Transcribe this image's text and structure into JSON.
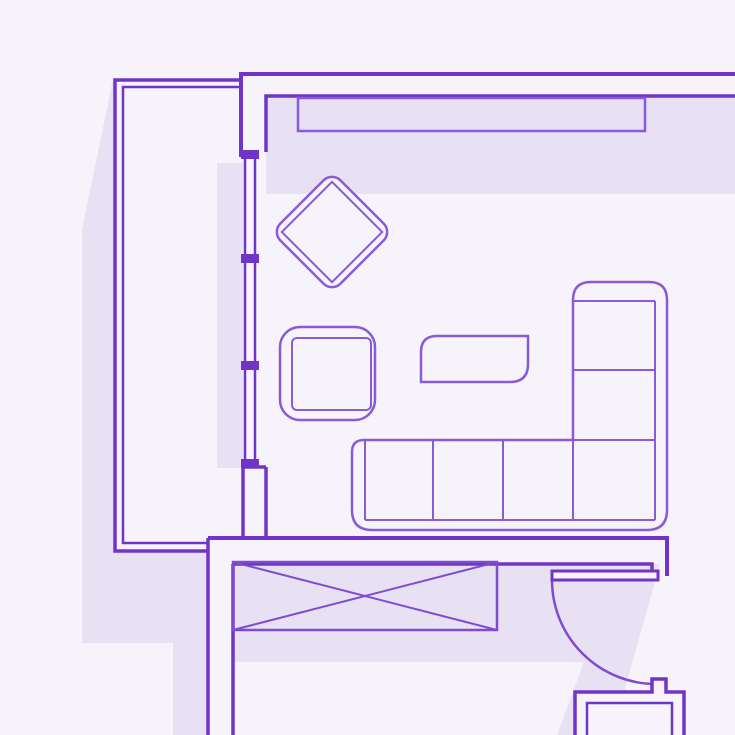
{
  "canvas": {
    "width": 735,
    "height": 735
  },
  "colors": {
    "bg": "#f7f3fb",
    "shadow": "#e8e1f4",
    "wall": "#7134c8",
    "furniture": "#8a5bd8",
    "box": "#7f4cd0"
  },
  "plan": {
    "items": [
      {
        "name": "shadow-top-band",
        "kind": "rect",
        "x": 266,
        "y": 96,
        "width": 469,
        "height": 98,
        "fill": "shadow"
      },
      {
        "name": "shadow-balcony-strip",
        "kind": "rect",
        "x": 217,
        "y": 163,
        "width": 26,
        "height": 305,
        "fill": "shadow"
      },
      {
        "name": "shadow-left-wing",
        "kind": "polygon",
        "pts": [
          [
            113,
            79
          ],
          [
            82,
            230
          ],
          [
            82,
            643
          ],
          [
            173,
            643
          ],
          [
            173,
            735
          ],
          [
            208,
            735
          ],
          [
            208,
            551
          ],
          [
            115,
            551
          ],
          [
            115,
            79
          ]
        ],
        "fill": "shadow"
      },
      {
        "name": "shadow-door-wing",
        "kind": "polygon",
        "pts": [
          [
            233,
            564
          ],
          [
            660,
            564
          ],
          [
            612,
            735
          ],
          [
            557,
            735
          ],
          [
            584,
            662
          ],
          [
            233,
            662
          ]
        ],
        "fill": "shadow"
      },
      {
        "name": "wall-top-outer",
        "kind": "path",
        "d": "M241,157 L241,74 L735,74",
        "stroke": "wall",
        "sw": 4
      },
      {
        "name": "wall-top-inner",
        "kind": "path",
        "d": "M266,152 L266,96 L735,96",
        "stroke": "wall",
        "sw": 3.5
      },
      {
        "name": "wall-balcony-outer",
        "kind": "path",
        "d": "M241,80 L115,80 L115,551 L208,551",
        "stroke": "wall",
        "sw": 3.5
      },
      {
        "name": "wall-balcony-inner",
        "kind": "path",
        "d": "M240,87 L123,87 L123,543 L208,543",
        "stroke": "wall",
        "sw": 2.5
      },
      {
        "name": "wall-below-window",
        "kind": "path",
        "d": "M243,467 L243,538 M266,467 L266,538 M243,467 L266,467",
        "stroke": "wall",
        "sw": 3.5
      },
      {
        "name": "wall-bottom-inner",
        "kind": "path",
        "d": "M208,538 L667,538 L667,576",
        "stroke": "wall",
        "sw": 4
      },
      {
        "name": "wall-bottom-outer",
        "kind": "path",
        "d": "M233,564 L652,564 L652,571",
        "stroke": "wall",
        "sw": 3.5
      },
      {
        "name": "wall-left-corridor",
        "kind": "path",
        "d": "M208,538 L208,735 M233,564 L233,735",
        "stroke": "wall",
        "sw": 3.5
      },
      {
        "name": "window-glass-lines",
        "kind": "path",
        "d": "M245,157 L245,464 M255,157 L255,464",
        "stroke": "wall",
        "sw": 2.5
      },
      {
        "name": "window-mullion-top",
        "kind": "rect",
        "x": 241,
        "y": 150,
        "width": 18,
        "height": 9,
        "fill": "wall"
      },
      {
        "name": "window-mullion-mid1",
        "kind": "rect",
        "x": 241,
        "y": 254,
        "width": 18,
        "height": 9,
        "fill": "wall"
      },
      {
        "name": "window-mullion-mid2",
        "kind": "rect",
        "x": 241,
        "y": 361,
        "width": 18,
        "height": 9,
        "fill": "wall"
      },
      {
        "name": "window-mullion-bottom",
        "kind": "rect",
        "x": 241,
        "y": 459,
        "width": 18,
        "height": 9,
        "fill": "wall"
      },
      {
        "name": "wall-shelf",
        "kind": "rect",
        "x": 298,
        "y": 98,
        "width": 347,
        "height": 33,
        "stroke": "furniture",
        "sw": 2.5,
        "fill": "none"
      },
      {
        "name": "wardrobe-box",
        "kind": "rect",
        "x": 233,
        "y": 562,
        "width": 264,
        "height": 68,
        "stroke": "box",
        "sw": 2.5,
        "fill": "none"
      },
      {
        "name": "wardrobe-cross",
        "kind": "path",
        "d": "M233,562 L497,630 M233,630 L497,562",
        "stroke": "box",
        "sw": 2,
        "fill": "none"
      },
      {
        "name": "door-swing-arc",
        "kind": "path",
        "d": "M552,580 A104,104 0 0 0 656,684",
        "stroke": "box",
        "sw": 2.5,
        "fill": "none"
      },
      {
        "name": "door-leaf",
        "kind": "rect",
        "x": 552,
        "y": 571,
        "width": 106,
        "height": 9,
        "stroke": "wall",
        "sw": 3,
        "fill": "bg"
      },
      {
        "name": "appliance-outer",
        "kind": "path",
        "d": "M575,735 L575,692 L652,692 L652,679 L666,679 L666,692 L684,692 L684,735",
        "stroke": "wall",
        "sw": 3.5,
        "fill": "bg"
      },
      {
        "name": "appliance-inner",
        "kind": "path",
        "d": "M587,735 L587,703 L672,703 L672,735",
        "stroke": "wall",
        "sw": 2.5,
        "fill": "bg"
      },
      {
        "name": "sofa-outline",
        "kind": "path",
        "d": "M352,452 Q352,440 364,440 L573,440 L573,300 Q573,282 591,282 L649,282 Q667,282 667,300 L667,510 Q667,530 647,530 L372,530 Q352,530 352,510 Z",
        "stroke": "furniture",
        "sw": 2.5,
        "fill": "bg"
      },
      {
        "name": "sofa-cushion-lines",
        "kind": "path",
        "d": "M365,440 L365,520 M365,520 L655,520 M433,440 L433,520 M503,440 L503,520 M573,440 L573,520 M573,440 L655,440 M573,301 L655,301 M655,301 L655,520 M573,370 L655,370",
        "stroke": "furniture",
        "sw": 2,
        "fill": "none"
      },
      {
        "name": "armchair-outline",
        "kind": "rect",
        "x": 280,
        "y": 327,
        "width": 95,
        "height": 93,
        "rx": 20,
        "stroke": "furniture",
        "sw": 2.5,
        "fill": "bg"
      },
      {
        "name": "armchair-seat",
        "kind": "rect",
        "x": 292,
        "y": 338,
        "width": 79,
        "height": 72,
        "rx": 5,
        "stroke": "furniture",
        "sw": 2,
        "fill": "none"
      },
      {
        "name": "coffee-table",
        "kind": "path",
        "d": "M437,336 L528,336 L528,364 Q528,382 510,382 L421,382 L421,352 Q421,336 437,336 Z",
        "stroke": "furniture",
        "sw": 2.5,
        "fill": "bg"
      },
      {
        "name": "accent-chair-outline",
        "kind": "rect",
        "x": 289.5,
        "y": 189.5,
        "width": 85,
        "height": 85,
        "rx": 12,
        "stroke": "furniture",
        "sw": 2.5,
        "fill": "bg",
        "transform": "rotate(45 332 232)"
      },
      {
        "name": "accent-chair-seat",
        "kind": "rect",
        "x": 296.5,
        "y": 196.5,
        "width": 71,
        "height": 71,
        "stroke": "furniture",
        "sw": 2,
        "fill": "none",
        "transform": "rotate(45 332 232)"
      }
    ]
  }
}
